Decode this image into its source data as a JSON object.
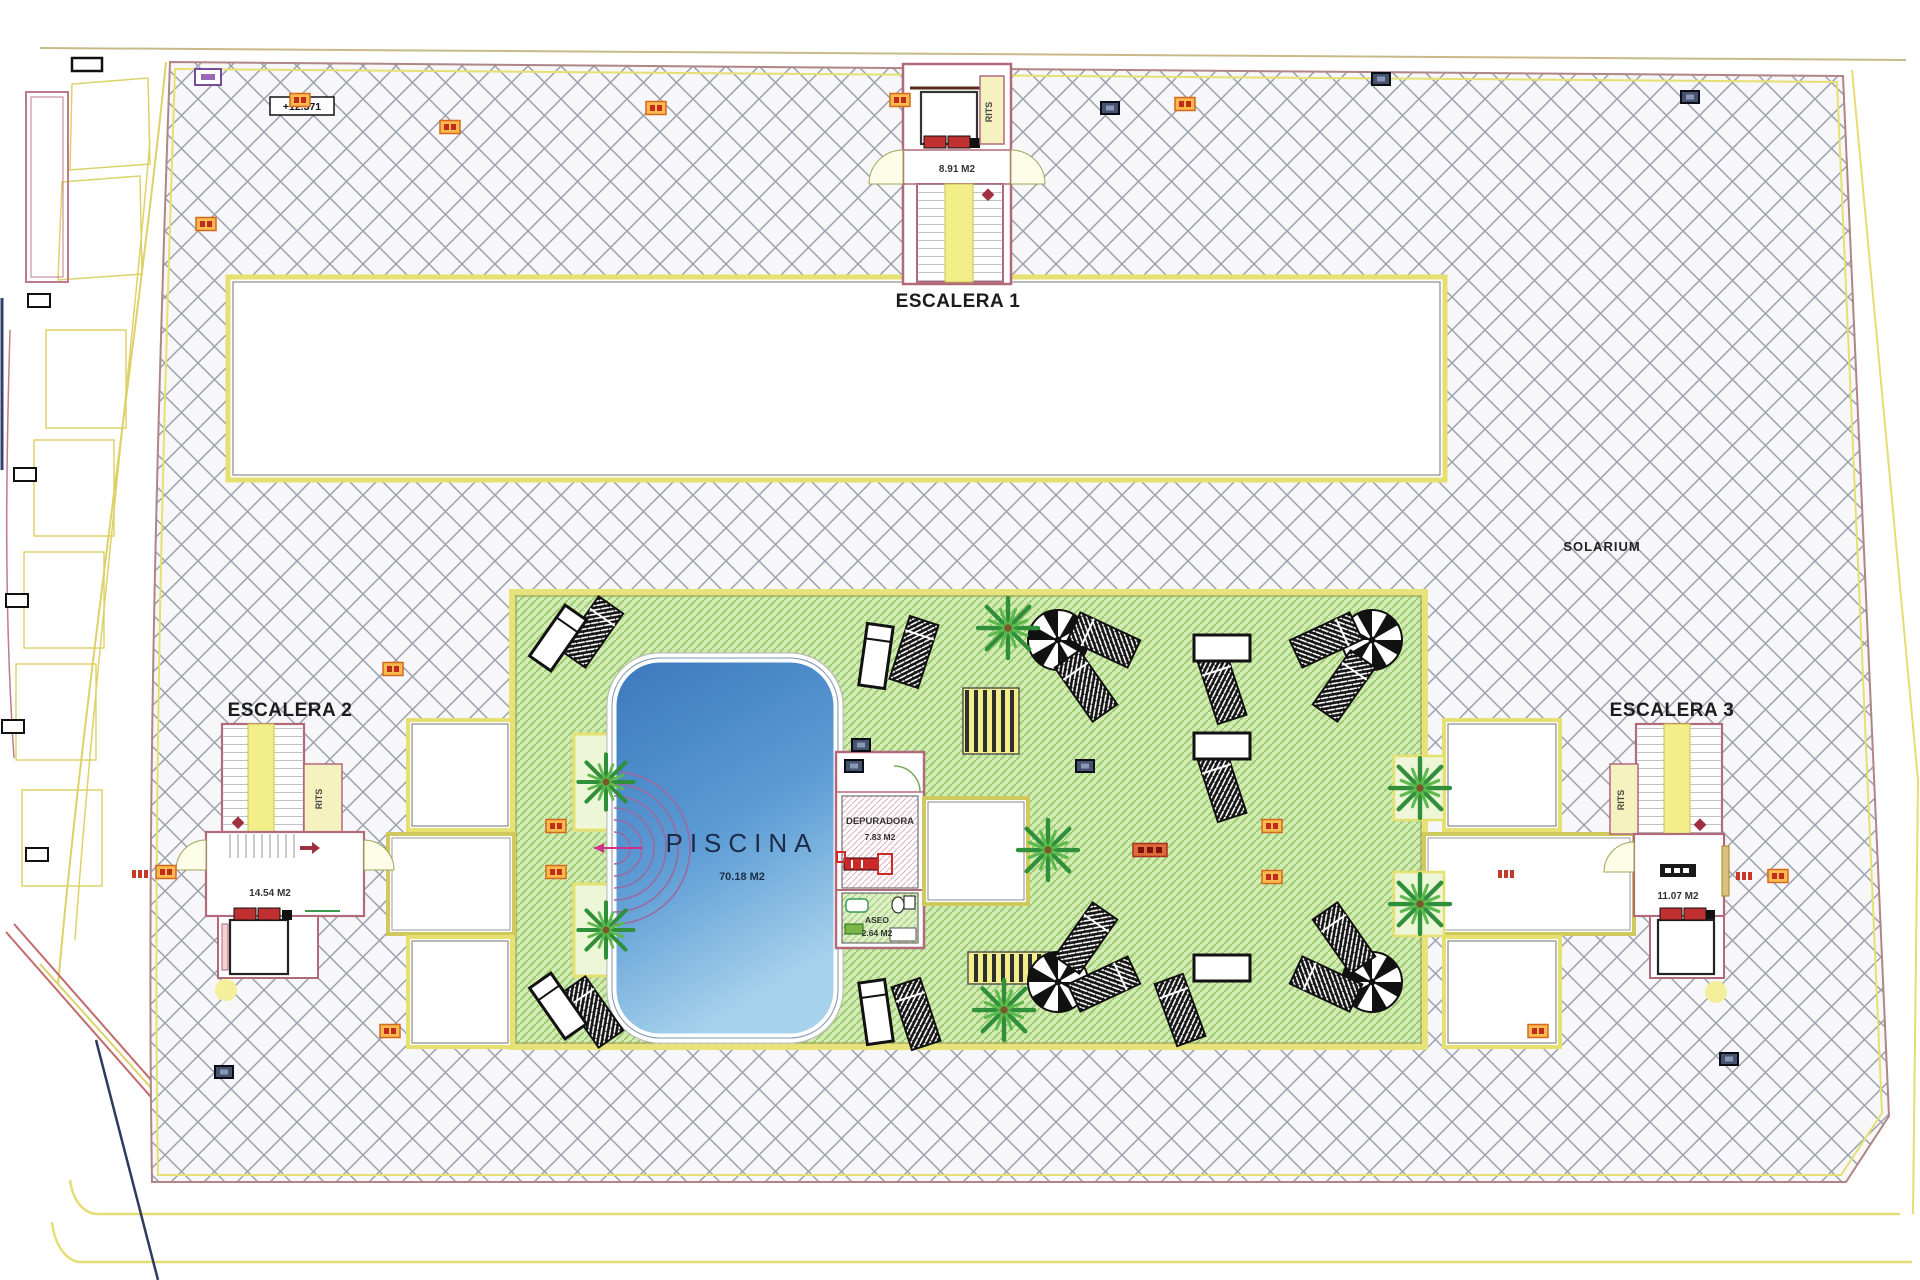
{
  "drawing": {
    "title": "rooftop-solarium-floor-plan",
    "stairwell_1": {
      "label": "ESCALERA 1",
      "area": "8.91 M2",
      "telecom_room": "RITS"
    },
    "stairwell_2": {
      "label": "ESCALERA 2",
      "area": "14.54 M2",
      "telecom_room": "RITS"
    },
    "stairwell_3": {
      "label": "ESCALERA 3",
      "area": "11.07 M2",
      "telecom_room": "RITS"
    },
    "solarium_label": "SOLARIUM",
    "pool": {
      "label": "PISCINA",
      "area": "70.18 M2"
    },
    "plant_room": {
      "label": "DEPURADORA",
      "area": "7.83 M2"
    },
    "toilet": {
      "label": "ASEO",
      "area": "2.64 M2"
    },
    "elevation_mark": "+12.371"
  },
  "colors": {
    "deck_hatch_line": "#9ba1ac",
    "deck_fill": "#f7f7f9",
    "lawn_fill": "#d3ecb4",
    "lawn_hatch_line": "#9ccb72",
    "pool_deep": "#3a78bd",
    "pool_shallow": "#a6d2ec",
    "wall_pink": "#b06a7a",
    "boundary_yellow": "#ddd26a",
    "stair_yellow": "#f2ee8a",
    "marker_orange": "#f9bb4d",
    "marker_blue": "#46536f",
    "accent_red": "#c03030",
    "palm_green": "#2f8f3a"
  }
}
